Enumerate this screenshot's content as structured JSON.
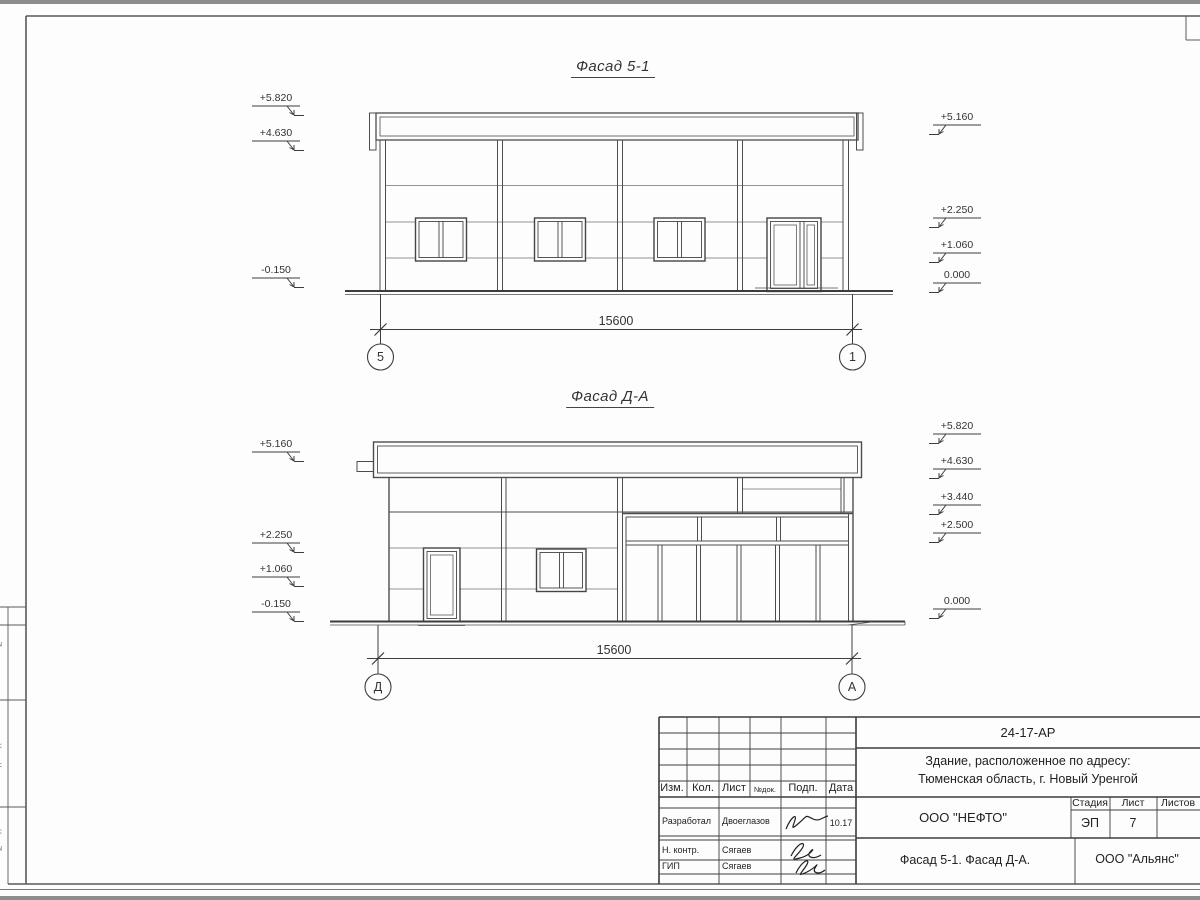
{
  "facade1": {
    "title": "Фасад 5-1",
    "left_marks": [
      "+5.820",
      "+4.630",
      "-0.150"
    ],
    "right_marks": [
      "+5.160",
      "+2.250",
      "+1.060",
      "0.000"
    ],
    "dimension": "15600",
    "axes": [
      "5",
      "1"
    ]
  },
  "facade2": {
    "title": "Фасад Д-А",
    "left_marks": [
      "+5.160",
      "+2.250",
      "+1.060",
      "-0.150"
    ],
    "right_marks": [
      "+5.820",
      "+4.630",
      "+3.440",
      "+2.500",
      "0.000"
    ],
    "dimension": "15600",
    "axes": [
      "Д",
      "А"
    ]
  },
  "titleblock": {
    "doc_number": "24-17-АР",
    "project_line1": "Здание, расположенное по адресу:",
    "project_line2": "Тюменская область, г. Новый Уренгой",
    "designer_org": "ООО \"НЕФТО\"",
    "sheet_name": "Фасад 5-1. Фасад Д-А.",
    "client_org": "ООО \"Альянс\"",
    "stage_label": "Стадия",
    "sheet_label": "Лист",
    "sheets_label": "Листов",
    "stage_value": "ЭП",
    "sheet_value": "7",
    "rev_columns": [
      "Изм.",
      "Кол.",
      "Лист",
      "№док.",
      "Подп.",
      "Дата"
    ],
    "signers": [
      {
        "role": "Разработал",
        "name": "Двоеглазов",
        "date": "10.17"
      },
      {
        "role": "Н. контр.",
        "name": "Сягаев",
        "date": ""
      },
      {
        "role": "ГИП",
        "name": "Сягаев",
        "date": ""
      }
    ]
  },
  "margin_labels": [
    "Взам. инв. №",
    "Подп. и дата",
    "Инв. № подл."
  ]
}
